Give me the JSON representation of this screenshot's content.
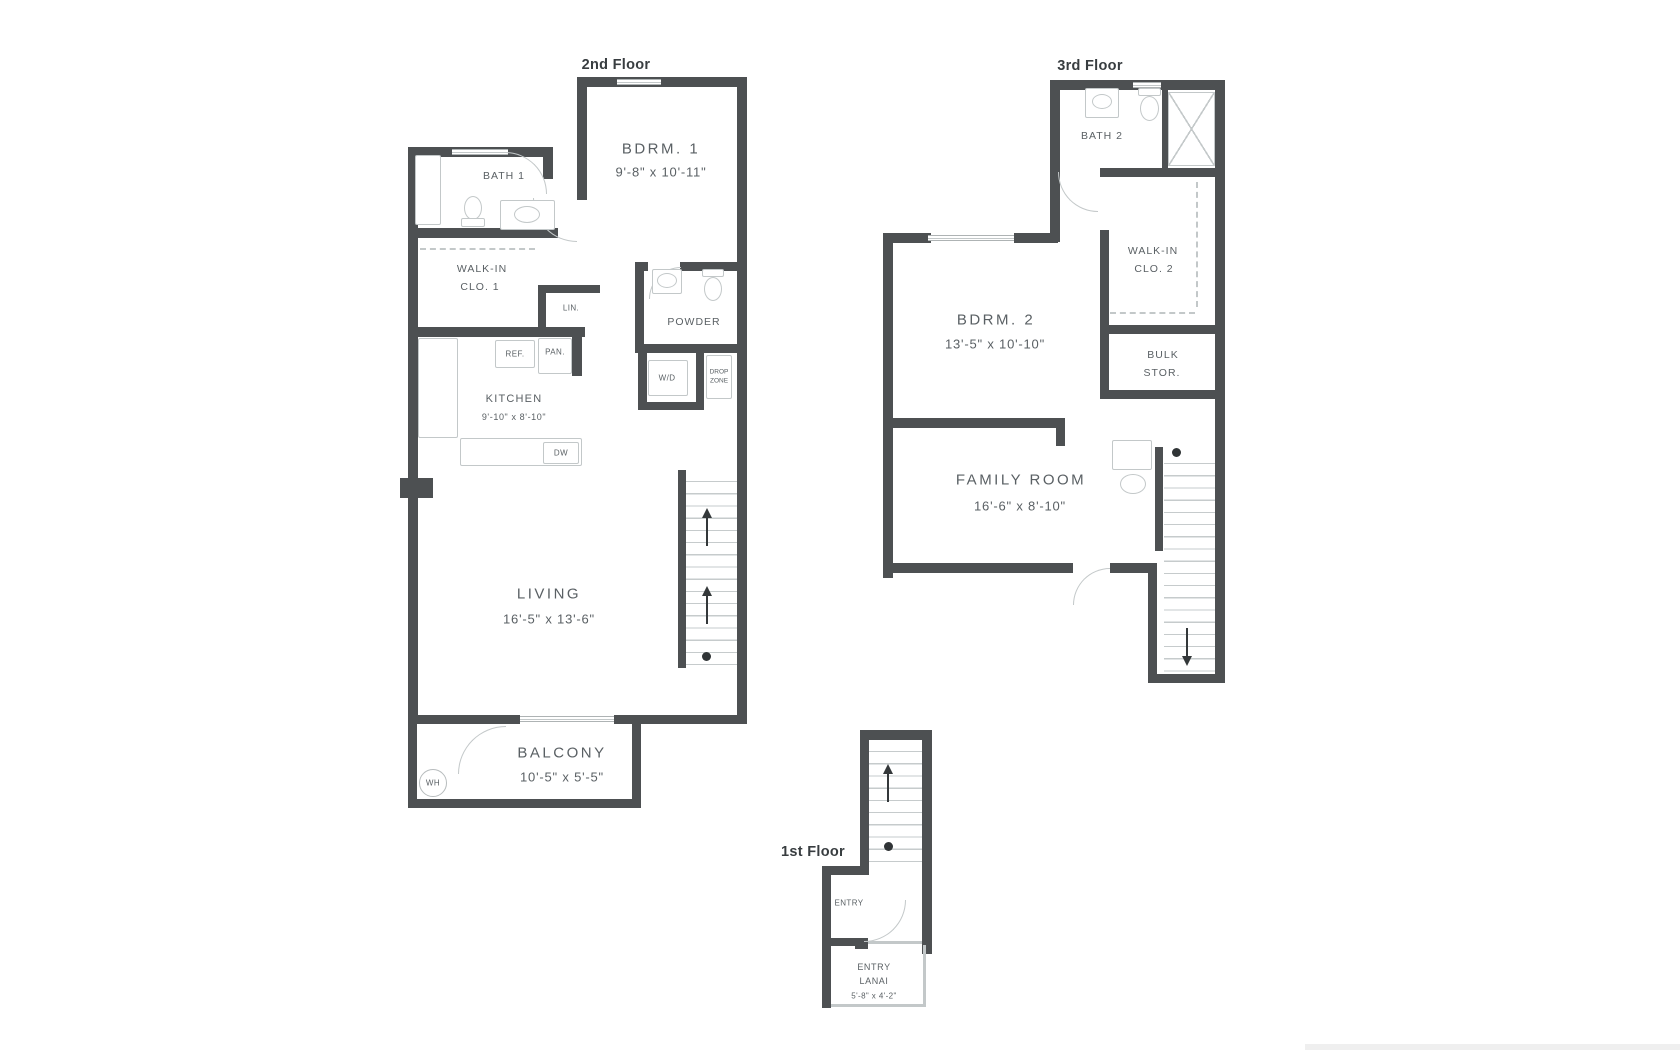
{
  "colors": {
    "wall": "#4d5052",
    "fixture_line": "#c3c8c9",
    "label_text": "#5a6064",
    "title_text": "#383d40"
  },
  "floor2": {
    "title": "2nd Floor",
    "bdrm1": {
      "name": "BDRM. 1",
      "dims": "9'-8\" x 10'-11\""
    },
    "bath1": {
      "name": "BATH 1"
    },
    "walkin": {
      "line1": "WALK-IN",
      "line2": "CLO. 1"
    },
    "lin": "LIN.",
    "powder": "POWDER",
    "ref": "REF.",
    "pan": "PAN.",
    "kitchen": {
      "name": "KITCHEN",
      "dims": "9'-10\" x 8'-10\""
    },
    "dw": "DW",
    "wd": "W/D",
    "drop": {
      "line1": "DROP",
      "line2": "ZONE"
    },
    "living": {
      "name": "LIVING",
      "dims": "16'-5\" x 13'-6\""
    },
    "balcony": {
      "name": "BALCONY",
      "dims": "10'-5\" x 5'-5\""
    },
    "wh": "WH"
  },
  "floor3": {
    "title": "3rd Floor",
    "bath2": {
      "name": "BATH 2"
    },
    "walkin": {
      "line1": "WALK-IN",
      "line2": "CLO. 2"
    },
    "bdrm2": {
      "name": "BDRM. 2",
      "dims": "13'-5\" x 10'-10\""
    },
    "bulk": {
      "line1": "BULK",
      "line2": "STOR."
    },
    "family": {
      "name": "FAMILY ROOM",
      "dims": "16'-6\" x 8'-10\""
    }
  },
  "floor1": {
    "title": "1st Floor",
    "entry": "ENTRY",
    "lanai": {
      "line1": "ENTRY",
      "line2": "LANAI",
      "dims": "5'-8\" x 4'-2\""
    }
  }
}
